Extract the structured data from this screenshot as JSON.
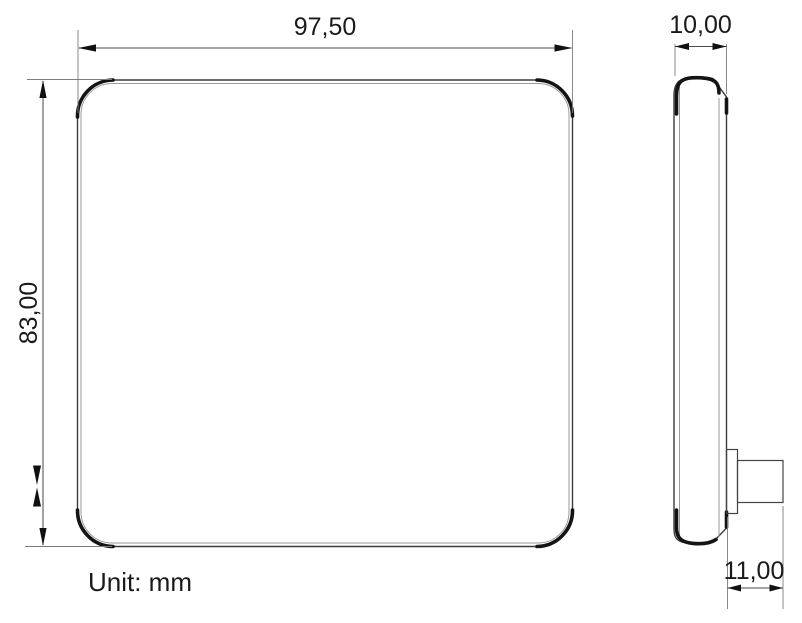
{
  "unit_label": "Unit: mm",
  "dimensions": {
    "width": {
      "label": "97,50",
      "value_mm": 97.5,
      "applies_to": "front view overall width"
    },
    "height": {
      "label": "83,00",
      "value_mm": 83.0,
      "applies_to": "front view overall height"
    },
    "thickness": {
      "label": "10,00",
      "value_mm": 10.0,
      "applies_to": "side view body thickness"
    },
    "stem_length": {
      "label": "11,00",
      "value_mm": 11.0,
      "applies_to": "rear mounting stem protrusion length"
    }
  },
  "views": {
    "front": {
      "name": "front view",
      "shape": "rounded square panel"
    },
    "side": {
      "name": "side profile view",
      "shape": "thin slab with rear mounting stem near bottom"
    }
  },
  "colors": {
    "background": "#ffffff",
    "outline": "#3c3c3c",
    "inner_line": "#9a9a9a",
    "accent_stroke": "#141414",
    "dimension_line": "#4a4a4a",
    "extension_line": "#7d7d7d",
    "text": "#1a1a1a"
  }
}
